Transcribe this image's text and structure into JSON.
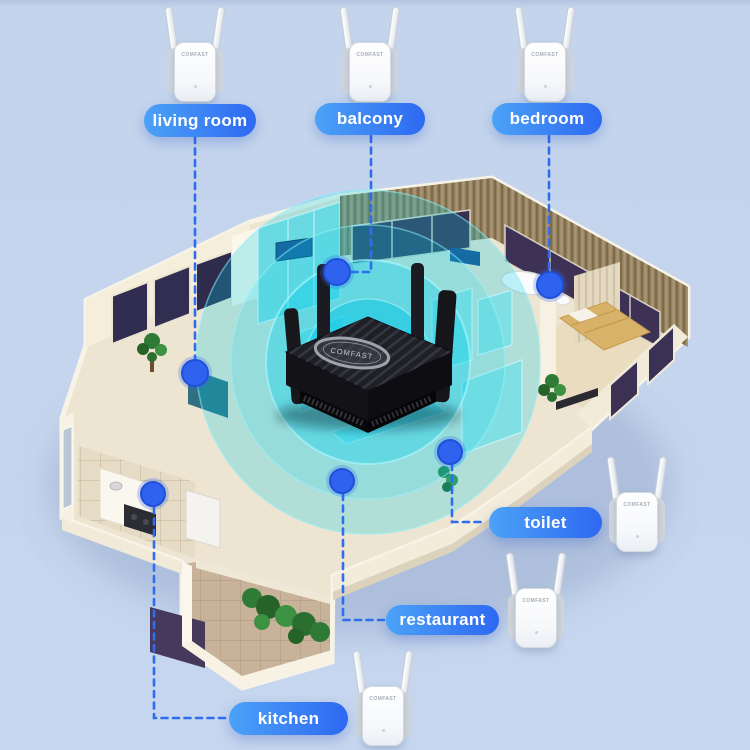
{
  "scene": {
    "background_color": "#c3d4ec",
    "label_gradient_start": "#4ba2f7",
    "label_gradient_end": "#2e68f2",
    "connector_color": "#2e6cf0",
    "signal_color": "#00cfe9"
  },
  "brand": {
    "router_logo": "COMFAST",
    "router_antenna_badge": "WiFi6",
    "extender_logo": "COMFAST"
  },
  "rooms": [
    {
      "id": "living-room",
      "label": "living room"
    },
    {
      "id": "balcony",
      "label": "balcony"
    },
    {
      "id": "bedroom",
      "label": "bedroom"
    },
    {
      "id": "toilet",
      "label": "toilet"
    },
    {
      "id": "restaurant",
      "label": "restaurant"
    },
    {
      "id": "kitchen",
      "label": "kitchen"
    }
  ]
}
